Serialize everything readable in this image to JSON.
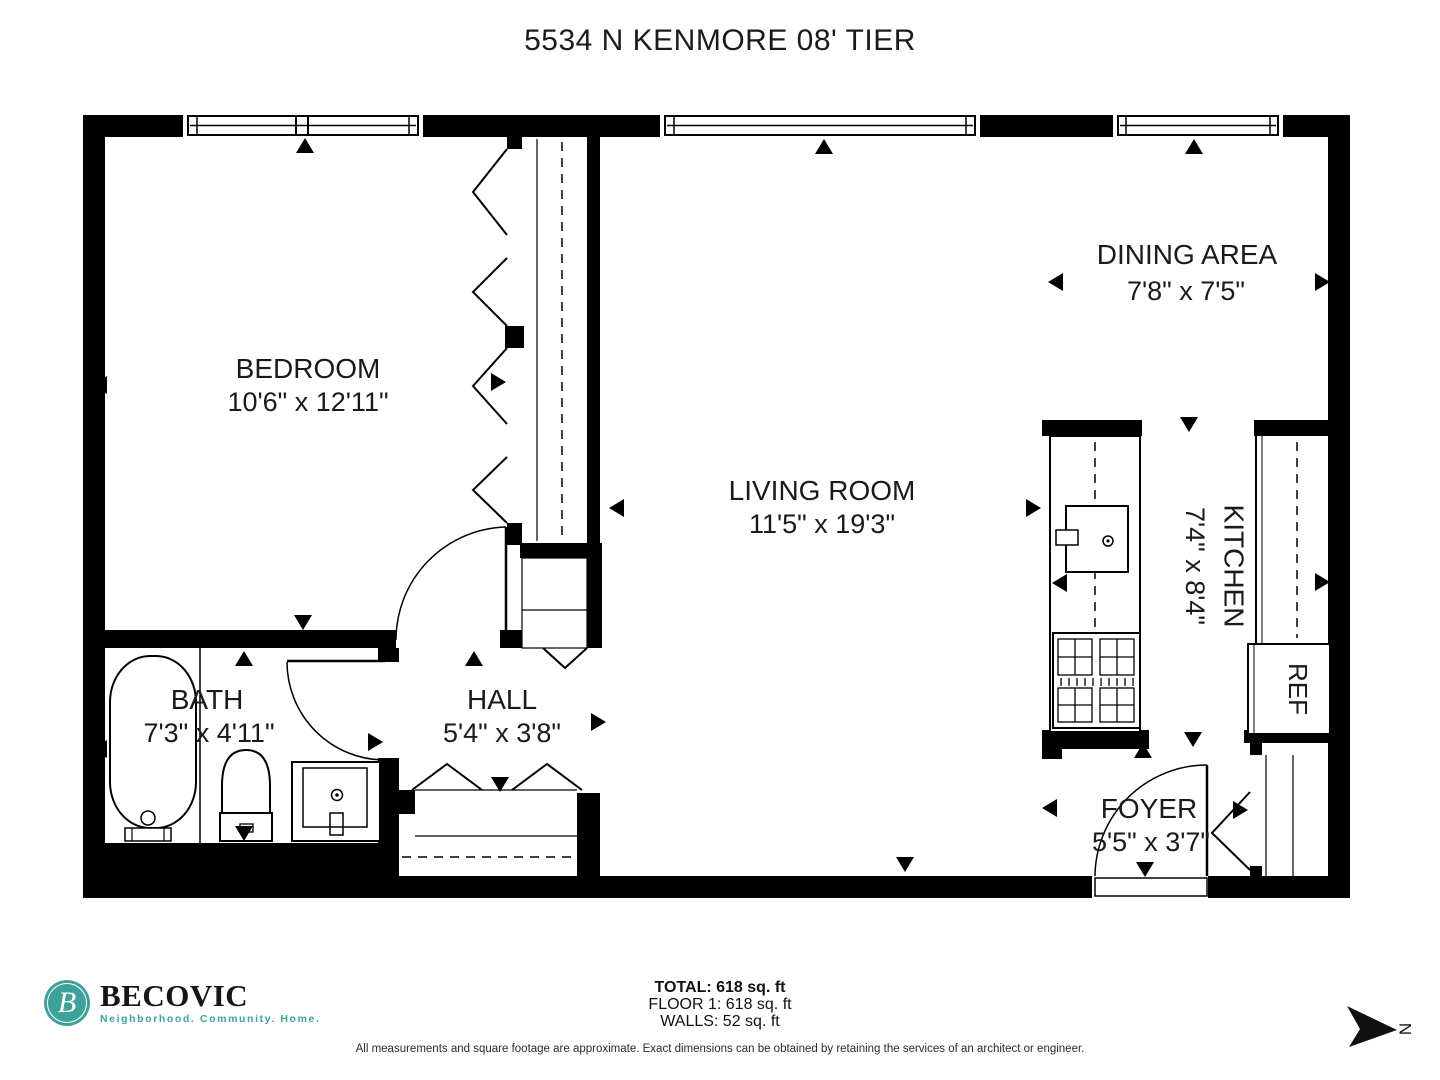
{
  "title": "5534 N KENMORE 08' TIER",
  "rooms": {
    "bedroom": {
      "name": "BEDROOM",
      "dims": "10'6\" x 12'11\""
    },
    "living_room": {
      "name": "LIVING ROOM",
      "dims": "11'5\" x 19'3\""
    },
    "dining_area": {
      "name": "DINING AREA",
      "dims": "7'8\" x 7'5\""
    },
    "kitchen": {
      "name": "KITCHEN",
      "dims": "7'4\" x 8'4\""
    },
    "bath": {
      "name": "BATH",
      "dims": "7'3\" x 4'11\""
    },
    "hall": {
      "name": "HALL",
      "dims": "5'4\" x 3'8\""
    },
    "foyer": {
      "name": "FOYER",
      "dims": "5'5\" x 3'7\""
    }
  },
  "fixtures": {
    "refrigerator": "REF"
  },
  "compass": {
    "north": "N"
  },
  "brand": {
    "name": "BECOVIC",
    "tagline": "Neighborhood. Community. Home.",
    "monogram": "B"
  },
  "summary": {
    "total": "TOTAL: 618 sq. ft",
    "floor": "FLOOR 1: 618 sq. ft",
    "walls": "WALLS: 52 sq. ft"
  },
  "disclaimer": "All measurements and square footage are approximate. Exact dimensions can be obtained by retaining the services of an architect or engineer.",
  "colors": {
    "ink": "#000000",
    "teal": "#3EA29B"
  }
}
